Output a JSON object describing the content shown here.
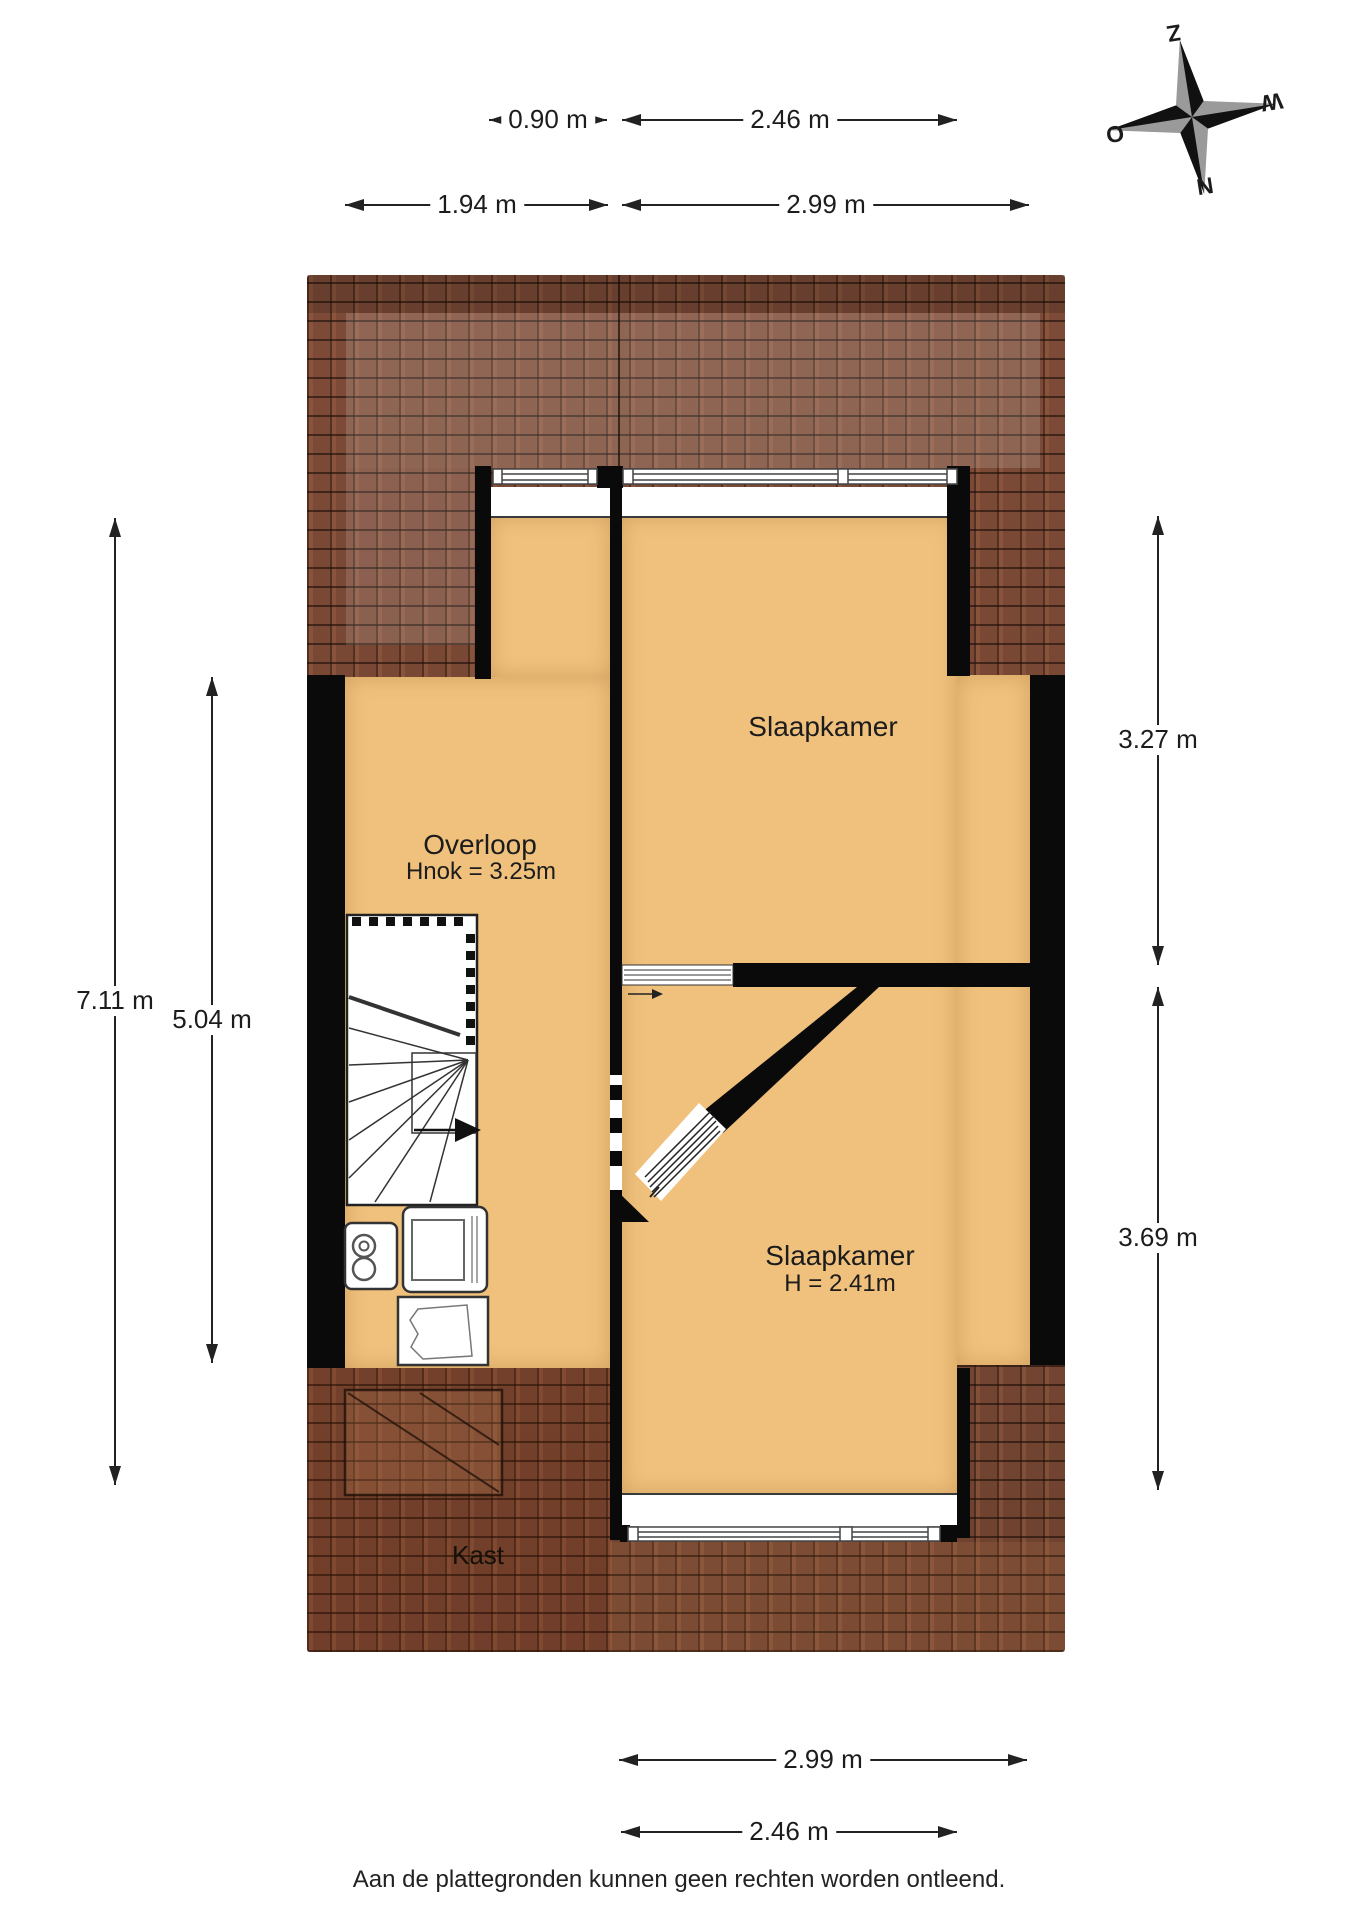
{
  "colors": {
    "floor": "#F0C17D",
    "roof_base": "#6E4130",
    "wall": "#0A0A0A",
    "text": "#1C1C1C"
  },
  "compass": {
    "south": "Z",
    "west": "W",
    "east": "O",
    "north": "N"
  },
  "rooms": {
    "bedroom_top": {
      "label": "Slaapkamer"
    },
    "landing": {
      "label": "Overloop",
      "sub": "Hnok = 3.25m"
    },
    "bedroom_bottom": {
      "label": "Slaapkamer",
      "sub": "H = 2.41m"
    },
    "closet": {
      "label": "Kast"
    }
  },
  "dimensions": {
    "top_window": "0.90 m",
    "top_dormer": "2.46 m",
    "top_landing_width": "1.94 m",
    "top_bedroom_width": "2.99 m",
    "right_bedroom_top": "3.27 m",
    "right_bedroom_bottom": "3.69 m",
    "left_total": "7.11 m",
    "left_landing": "5.04 m",
    "bottom_bedroom_width": "2.99 m",
    "bottom_window": "2.46 m"
  },
  "footer": {
    "disclaimer": "Aan de plattegronden kunnen geen rechten worden ontleend."
  }
}
